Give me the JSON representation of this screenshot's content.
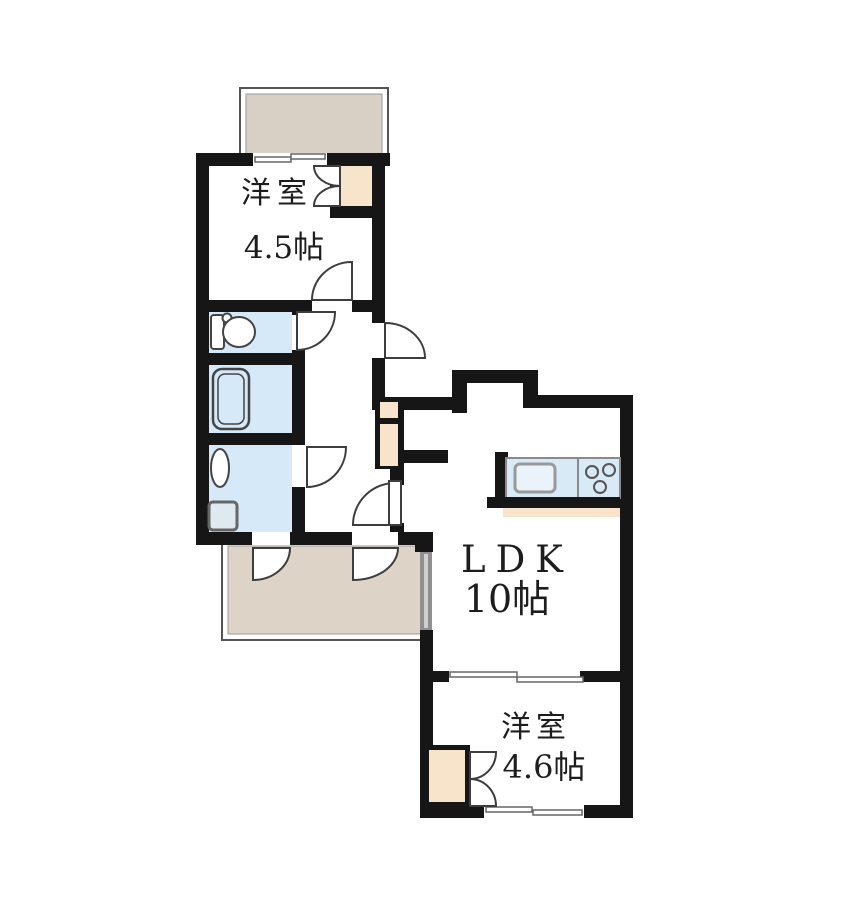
{
  "plan_title": "apartment-floor-plan",
  "rooms": [
    {
      "name": "洋室",
      "size": "4.5帖"
    },
    {
      "name": "LDK",
      "size": "10帖"
    },
    {
      "name": "洋室",
      "size": "4.6帖"
    }
  ],
  "fixtures": [
    "balcony",
    "sliding-window",
    "closet-double-door",
    "toilet",
    "bathtub",
    "washbasin",
    "washing-machine-pan",
    "hinged-door",
    "entrance-door",
    "entrance-corridor",
    "shoe-storage",
    "kitchen-counter",
    "kitchen-sink",
    "stove-burners",
    "sliding-partition-door",
    "fixed-window-panel"
  ],
  "colors": {
    "wall": "#161616",
    "wet_room_floor": "#d6e9f8",
    "closet_fill": "#f8e4cb",
    "balcony_fill": "#d8cfc5",
    "corridor_fill": "#ded3c7",
    "kitchen_counter": "#d8eaf6",
    "window_bar": "#8f8f8f",
    "outline": "#555555",
    "text": "#1d1d1d",
    "background": "#ffffff"
  }
}
